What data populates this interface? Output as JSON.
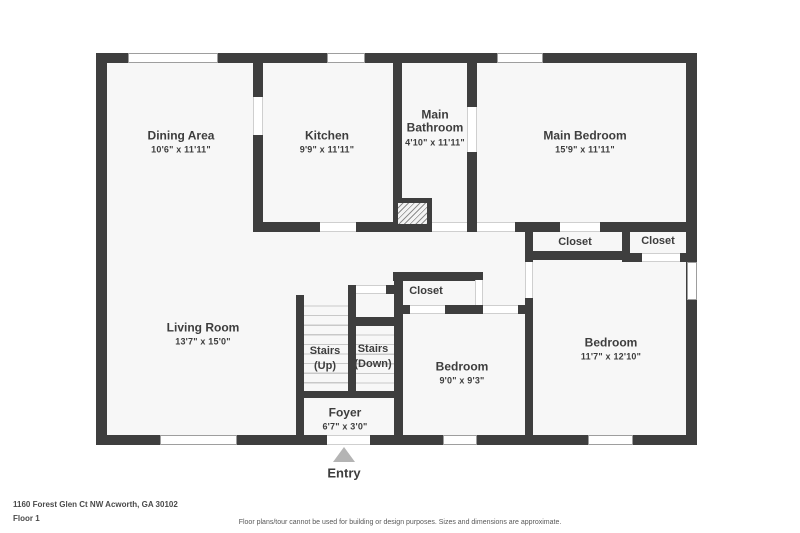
{
  "plan": {
    "rooms": [
      {
        "name": "Dining Area",
        "dims": "10'6\" x 11'11\""
      },
      {
        "name": "Kitchen",
        "dims": "9'9\" x 11'11\""
      },
      {
        "name": "Main Bathroom",
        "dims": "4'10\" x 11'11\""
      },
      {
        "name": "Main Bedroom",
        "dims": "15'9\" x 11'11\""
      },
      {
        "name": "Living Room",
        "dims": "13'7\" x 15'0\""
      },
      {
        "name": "Bedroom",
        "dims": "9'0\" x 9'3\""
      },
      {
        "name": "Bedroom",
        "dims": "11'7\" x 12'10\""
      },
      {
        "name": "Foyer",
        "dims": "6'7\" x 3'0\""
      }
    ],
    "closets": [
      {
        "label": "Closet"
      },
      {
        "label": "Closet"
      },
      {
        "label": "Closet"
      }
    ],
    "stairs": [
      {
        "line1": "Stairs",
        "line2": "(Up)"
      },
      {
        "line1": "Stairs",
        "line2": "(Down)"
      }
    ],
    "entry_label": "Entry"
  },
  "footer": {
    "address": "1160 Forest Glen Ct NW Acworth, GA 30102",
    "floor_label": "Floor 1",
    "disclaimer": "Floor plans/tour cannot be used for building or design purposes. Sizes and dimensions are approximate."
  },
  "colors": {
    "wall": "#3e3e3e",
    "floor_fill": "#f7f7f7",
    "window_frame": "#9e9e9e",
    "entry_arrow": "#b4b4b4",
    "text": "#3d3d3d"
  }
}
